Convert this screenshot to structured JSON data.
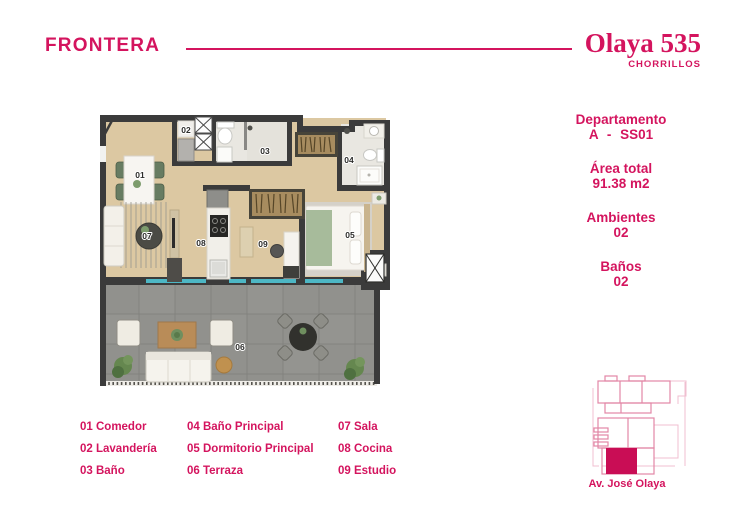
{
  "colors": {
    "accent": "#d4145e",
    "wall": "#3b3b3b",
    "wood_floor": "#dcc8a2",
    "terrace_floor": "#91918d",
    "window_glass": "#4db7c5",
    "siteplan_highlight": "#c90d55"
  },
  "header": {
    "logo": "FRONTERA",
    "project_name": "Olaya 535",
    "project_location": "CHORRILLOS"
  },
  "unit_info": {
    "groups": [
      {
        "label": "Departamento",
        "value": "A - SS01"
      },
      {
        "label": "Área total",
        "value": "91.38 m2"
      },
      {
        "label": "Ambientes",
        "value": "02"
      },
      {
        "label": "Baños",
        "value": "02"
      }
    ]
  },
  "floorplan": {
    "labels": {
      "n01": "01",
      "n02": "02",
      "n03": "03",
      "n04": "04",
      "n05": "05",
      "n06": "06",
      "n07": "07",
      "n08": "08",
      "n09": "09"
    }
  },
  "legend": {
    "columns": [
      [
        "01 Comedor",
        "02 Lavandería",
        "03 Baño"
      ],
      [
        "04 Baño Principal",
        "05 Dormitorio Principal",
        "06 Terraza"
      ],
      [
        "07 Sala",
        "08 Cocina",
        "09 Estudio"
      ]
    ]
  },
  "siteplan": {
    "street_label": "Av. José Olaya"
  }
}
